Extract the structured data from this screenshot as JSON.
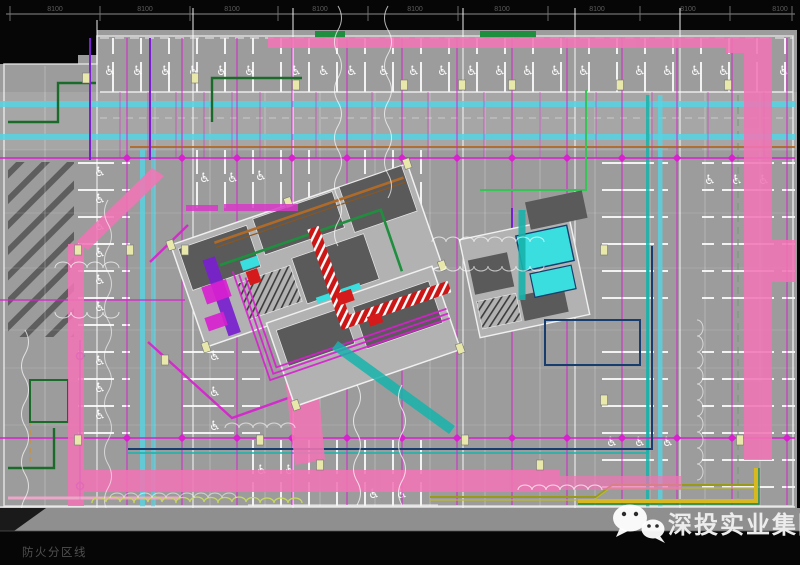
{
  "ruler": {
    "labels": [
      "8100",
      "8100",
      "8100",
      "8100",
      "8100",
      "8100",
      "8100",
      "8100",
      "8100"
    ]
  },
  "labels": {
    "fire_zone": "防火分区线"
  },
  "watermark": {
    "text": "深投实业集团",
    "icon": "wechat-icon"
  },
  "symbols": {
    "accessible_parking": "♿"
  },
  "palette": {
    "bg": "#060606",
    "plan": "#9c9c9c",
    "planLight": "#a6a6a6",
    "road": "#8f8f8f",
    "room": "#5a5a5a",
    "plate": "#b2b2b2",
    "wall": "#f0f0f0",
    "cyanBand": "#55d4e4",
    "tealDuct": "#17b3ab",
    "tankCyan": "#3adede",
    "pink": "#f175b5",
    "pinkLight": "#f6a8cf",
    "magenta": "#d91fd0",
    "red": "#d41a1a",
    "green": "#1f8f3f",
    "greenDark": "#1a6a2a",
    "greenBright": "#35c455",
    "purple": "#7a1fd0",
    "olive": "#99991a",
    "yellowCol": "#e8e8aa",
    "orange": "#b06a28",
    "navy": "#163d6e",
    "yellowLine": "#d8b820",
    "cloudYellow": "#c8d85e",
    "dimText": "#5d5d5d",
    "watermarkText": "#ececec",
    "fireText": "#4f4f4f",
    "mudMagenta": "#d838c8"
  }
}
